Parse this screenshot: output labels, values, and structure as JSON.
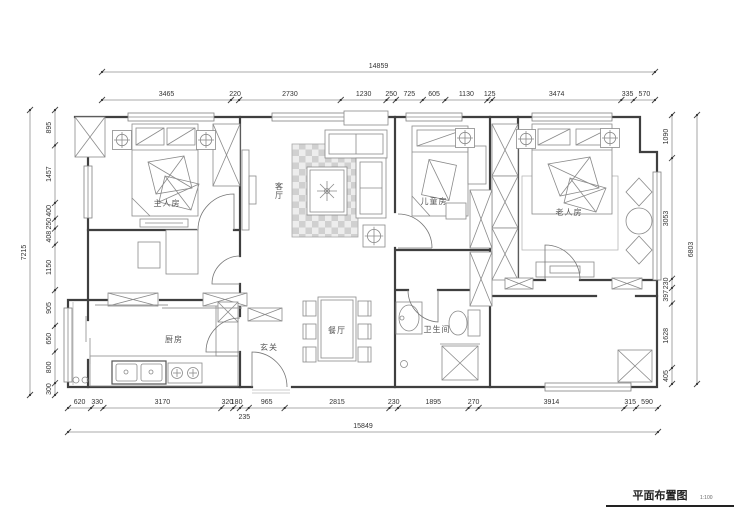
{
  "title": {
    "label": "平面布置图",
    "scale": "1:100"
  },
  "rooms": {
    "master": {
      "label": "主人房"
    },
    "living": {
      "label": "客厅"
    },
    "children": {
      "label": "儿童房"
    },
    "elder": {
      "label": "老人房"
    },
    "kitchen": {
      "label": "厨房"
    },
    "foyer": {
      "label": "玄关"
    },
    "dining": {
      "label": "餐厅"
    },
    "bathroom": {
      "label": "卫生间"
    }
  },
  "dimensions": {
    "top": {
      "total": "14859",
      "segments": [
        "3465",
        "220",
        "2730",
        "1230",
        "250",
        "725",
        "605",
        "1130",
        "125",
        "3474",
        "335",
        "570"
      ]
    },
    "bottom": {
      "total": "15849",
      "segments": [
        "620",
        "330",
        "3170",
        "320",
        "180",
        "235",
        "965",
        "2815",
        "230",
        "1895",
        "270",
        "3914",
        "315",
        "590"
      ]
    },
    "left": {
      "total": "7215",
      "segments": [
        "895",
        "1457",
        "400",
        "250",
        "408",
        "1150",
        "905",
        "650",
        "800",
        "300"
      ]
    },
    "right": {
      "total": "6803",
      "segments": [
        "1090",
        "3053",
        "230",
        "397",
        "1628",
        "405"
      ]
    }
  },
  "colors": {
    "ink": "#3f3f3f",
    "furniture": "#8a8a8a",
    "rug": "#d0d0d0"
  }
}
